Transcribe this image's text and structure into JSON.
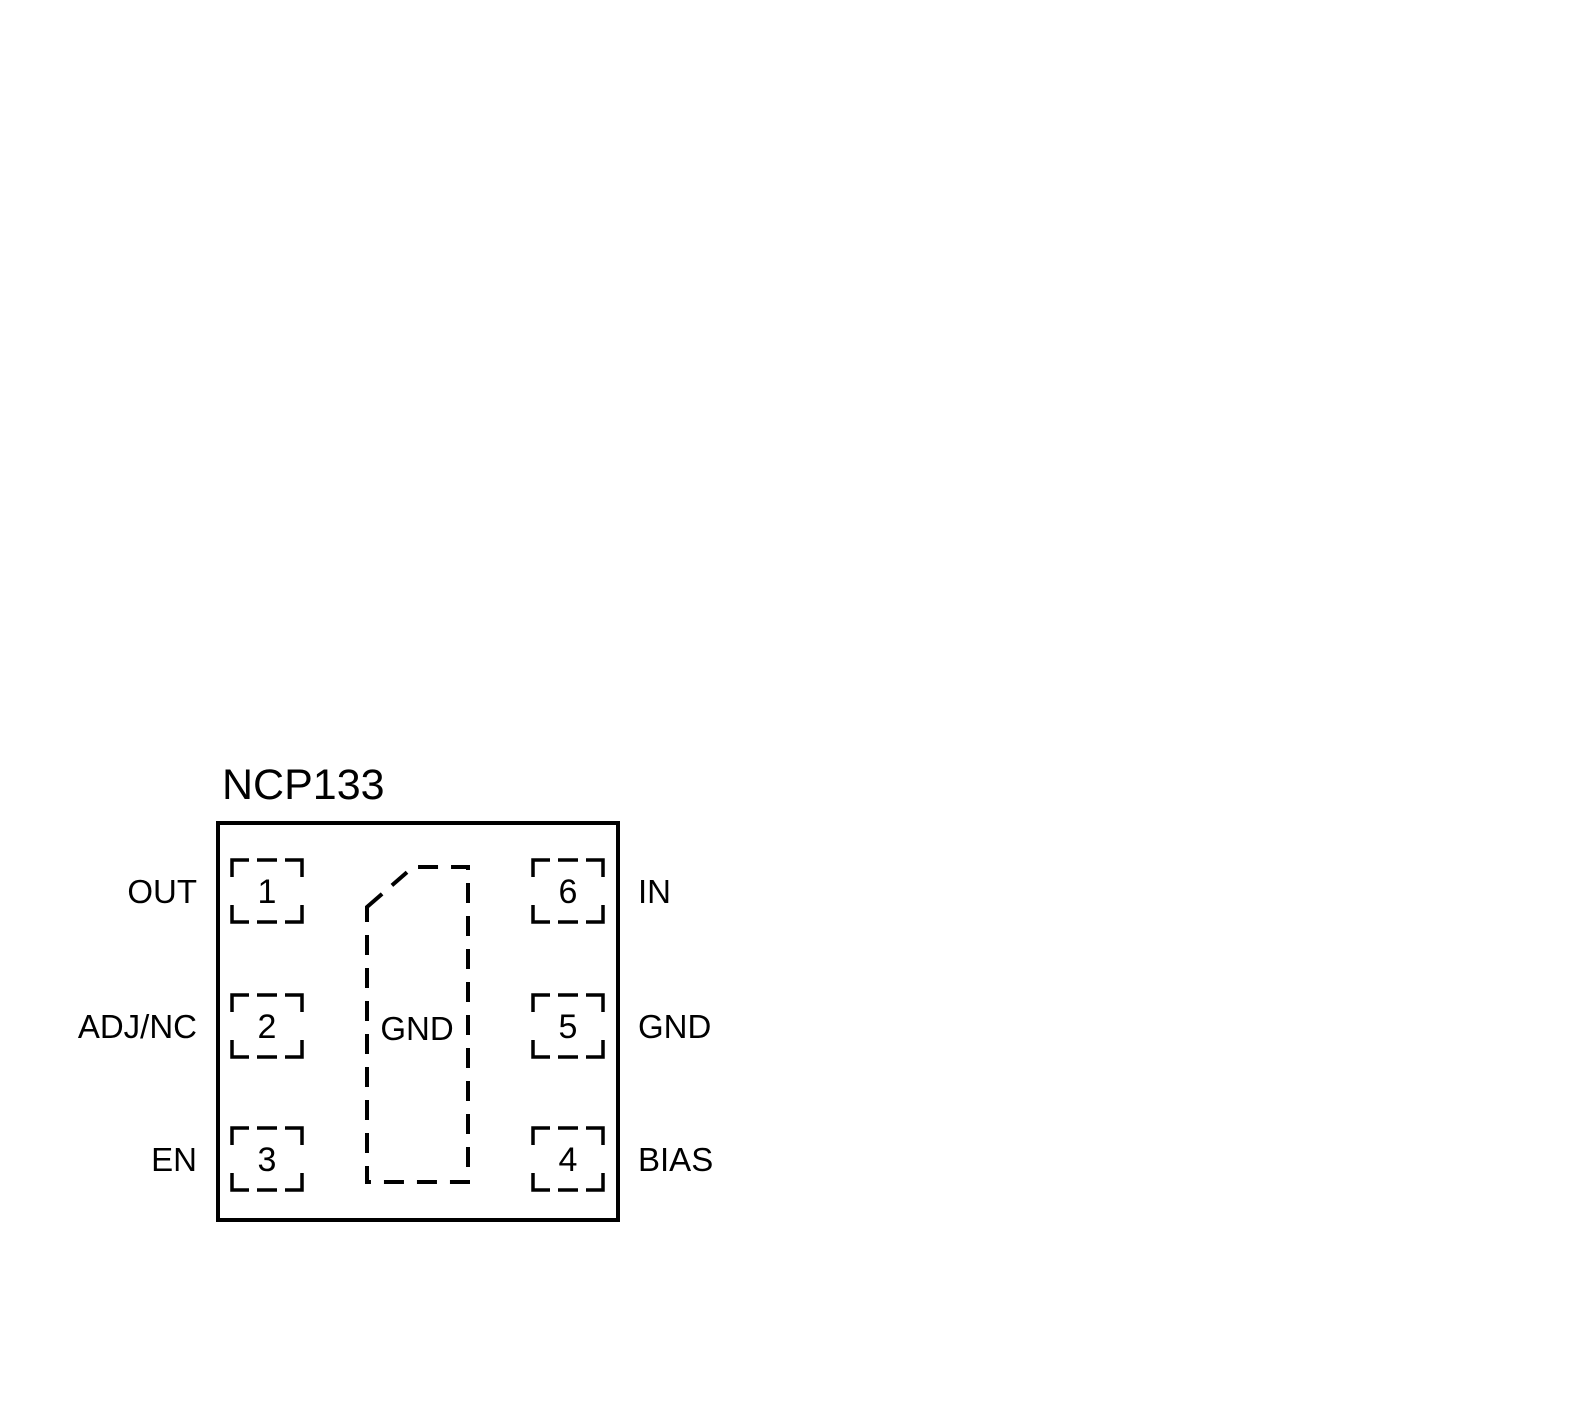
{
  "diagram": {
    "title": "NCP133",
    "pins": [
      {
        "number": "1",
        "label": "OUT",
        "side": "left"
      },
      {
        "number": "2",
        "label": "ADJ/NC",
        "side": "left"
      },
      {
        "number": "3",
        "label": "EN",
        "side": "left"
      },
      {
        "number": "4",
        "label": "BIAS",
        "side": "right"
      },
      {
        "number": "5",
        "label": "GND",
        "side": "right"
      },
      {
        "number": "6",
        "label": "IN",
        "side": "right"
      }
    ],
    "exposed_pad": {
      "label": "GND"
    },
    "colors": {
      "line": "#000000",
      "text": "#000000",
      "background": "#ffffff"
    }
  }
}
